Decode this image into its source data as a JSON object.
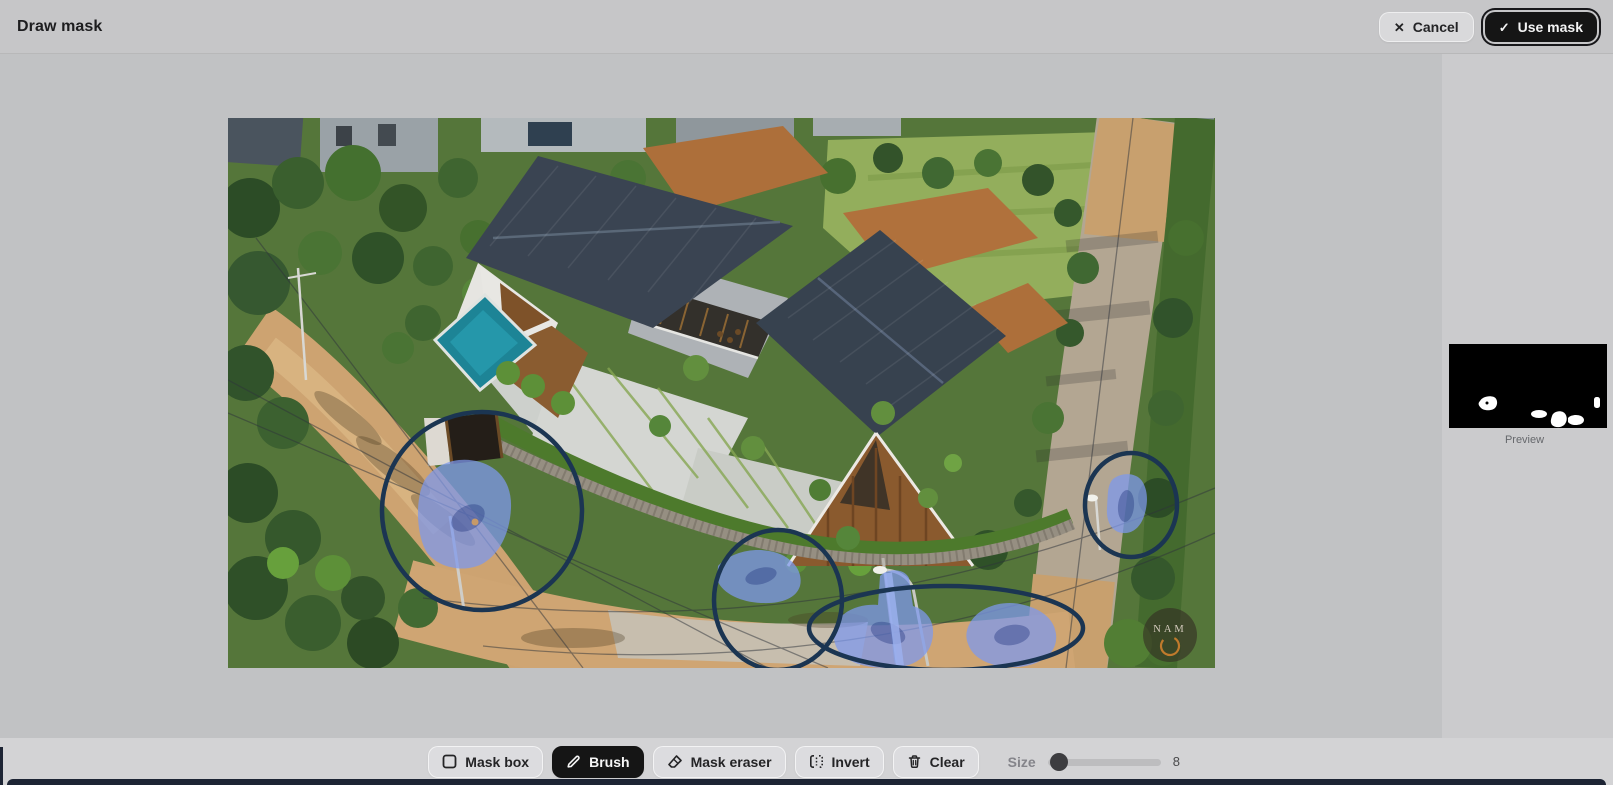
{
  "header": {
    "title": "Draw mask",
    "cancel_label": "Cancel",
    "use_mask_label": "Use mask"
  },
  "icons": {
    "close": "✕",
    "check": "✓"
  },
  "sidebar": {
    "preview_label": "Preview"
  },
  "toolbar": {
    "mask_box_label": "Mask box",
    "brush_label": "Brush",
    "mask_eraser_label": "Mask eraser",
    "invert_label": "Invert",
    "clear_label": "Clear",
    "active_tool": "Brush",
    "size": {
      "label": "Size",
      "value": "8"
    }
  },
  "canvas_image": {
    "description": "Aerial drone photo of a modern twin-gable house with pool and gardens; five blue brush-mask strokes painted over motorbikes and riders on the surrounding dirt roads, each ringed by a hand-drawn dark navy circle",
    "watermark": "NAM",
    "mask_count": 5
  },
  "colors": {
    "header_bg": "#c6c6c8",
    "canvas_bg": "#c1c2c4",
    "sidebar_bg": "#cbcbcd",
    "toolbar_bg": "#d3d3d5",
    "button_bg": "#dcdcdf",
    "button_text": "#242426",
    "dark_button_bg": "#151515",
    "dark_button_text": "#f4f4f4",
    "mask_blue": "#7d99ec",
    "outline_navy": "#1b3552",
    "preview_bg": "#000000",
    "preview_mask": "#ffffff",
    "bottom_bar": "#1d2434",
    "logo_ring_orange": "#c07a2c"
  }
}
